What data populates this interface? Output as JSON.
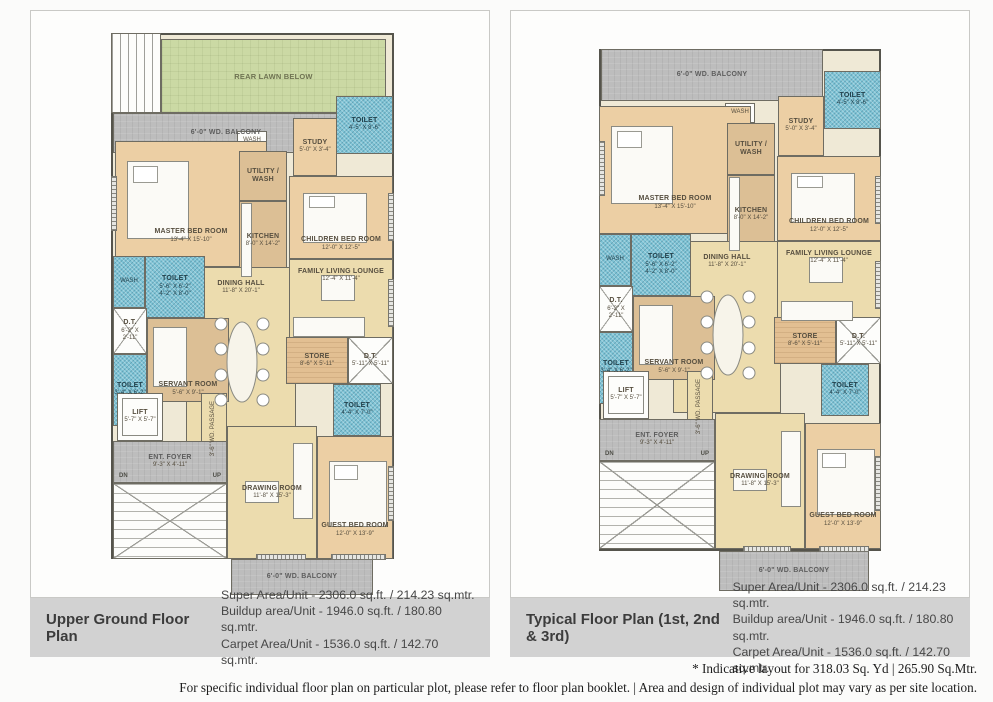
{
  "colors": {
    "toilet_blue": "#7fc4d6",
    "lawn_green": "#cbd9a4",
    "balcony_gray": "#bdbdbd",
    "floor_cream": "#ecdcae",
    "bedroom_tan": "#eccfa4",
    "kitchen_brown": "#dcbf95",
    "caption_band_gray": "#d2d2d2"
  },
  "footer": {
    "line1": "* Indicative layout for 318.03 Sq. Yd | 265.90 Sq.Mtr.",
    "line2": "For specific individual floor plan on particular plot, please refer to floor plan booklet. | Area and design of individual plot may vary as per site location."
  },
  "plans": [
    {
      "title": "Upper Ground Floor Plan",
      "areas": {
        "super": "Super Area/Unit - 2306.0 sq.ft. / 214.23 sq.mtr.",
        "buildup": "Buildup area/Unit - 1946.0 sq.ft. / 180.80 sq.mtr.",
        "carpet": "Carpet Area/Unit - 1536.0 sq.ft. / 142.70 sq.mtr."
      },
      "rooms": {
        "rear_lawn": {
          "label": "REAR LAWN BELOW"
        },
        "top_balcony": {
          "label": "6'-0\" WD. BALCONY"
        },
        "wash_top": {
          "label": "WASH"
        },
        "toilet_top": {
          "label": "TOILET",
          "dims": "4'-5\" X 8'-6\""
        },
        "study": {
          "label": "STUDY",
          "dims": "5'-0\" X 3'-4\""
        },
        "master_bed": {
          "label": "MASTER BED ROOM",
          "dims": "13'-4\" X 15'-10\""
        },
        "utility": {
          "label": "UTILITY / WASH"
        },
        "kitchen": {
          "label": "KITCHEN",
          "dims": "8'-0\" X 14'-2\""
        },
        "children_bed": {
          "label": "CHILDREN BED ROOM",
          "dims": "12'-0\" X 12'-5\""
        },
        "dining": {
          "label": "DINING HALL",
          "dims": "11'-8\" X 20'-1\""
        },
        "family_lounge": {
          "label": "FAMILY LIVING LOUNGE",
          "dims": "12'-4\" X 11'-4\""
        },
        "wash_left": {
          "label": "WASH"
        },
        "toilet_mid": {
          "label": "TOILET",
          "dims": "5'-6\" X 6'-2\"",
          "dims2": "4'-2\" X 8'-0\""
        },
        "dt_left": {
          "label": "D.T.",
          "dims": "6'-2\" X 2'-11\""
        },
        "toilet_lower": {
          "label": "TOILET",
          "dims": "3'-4\" X 6'-2\""
        },
        "servant": {
          "label": "SERVANT ROOM",
          "dims": "5'-6\" X 9'-1\""
        },
        "store": {
          "label": "STORE",
          "dims": "8'-6\" X 5'-11\""
        },
        "dt_right": {
          "label": "D.T.",
          "dims": "5'-11\" X 5'-11\""
        },
        "toilet_right": {
          "label": "TOILET",
          "dims": "4'-4\" X 7'-0\""
        },
        "lift": {
          "label": "LIFT",
          "dims": "5'-7\" X 5'-7\""
        },
        "passage": {
          "label": "3'-6\" WD. PASSAGE"
        },
        "ent_foyer": {
          "label": "ENT. FOYER",
          "dims": "9'-3\" X 4'-11\""
        },
        "dn": {
          "label": "DN"
        },
        "up": {
          "label": "UP"
        },
        "drawing": {
          "label": "DRAWING ROOM",
          "dims": "11'-8\" X 15'-3\""
        },
        "guest_bed": {
          "label": "GUEST BED ROOM",
          "dims": "12'-0\" X 13'-9\""
        },
        "bottom_balcony": {
          "label": "6'-0\" WD. BALCONY"
        }
      }
    },
    {
      "title": "Typical Floor Plan (1st, 2nd & 3rd)",
      "areas": {
        "super": "Super Area/Unit - 2306.0 sq.ft. / 214.23 sq.mtr.",
        "buildup": "Buildup area/Unit - 1946.0 sq.ft. / 180.80 sq.mtr.",
        "carpet": "Carpet Area/Unit - 1536.0 sq.ft. / 142.70 sq.mtr."
      },
      "rooms": {
        "top_balcony": {
          "label": "6'-0\" WD. BALCONY"
        },
        "wash_top": {
          "label": "WASH"
        },
        "toilet_top": {
          "label": "TOILET",
          "dims": "4'-5\" X 8'-6\""
        },
        "study": {
          "label": "STUDY",
          "dims": "5'-0\" X 3'-4\""
        },
        "master_bed": {
          "label": "MASTER BED ROOM",
          "dims": "13'-4\" X 15'-10\""
        },
        "utility": {
          "label": "UTILITY / WASH"
        },
        "kitchen": {
          "label": "KITCHEN",
          "dims": "8'-0\" X 14'-2\""
        },
        "children_bed": {
          "label": "CHILDREN BED ROOM",
          "dims": "12'-0\" X 12'-5\""
        },
        "dining": {
          "label": "DINING HALL",
          "dims": "11'-8\" X 20'-1\""
        },
        "family_lounge": {
          "label": "FAMILY LIVING LOUNGE",
          "dims": "12'-4\" X 11'-4\""
        },
        "wash_left": {
          "label": "WASH"
        },
        "toilet_mid": {
          "label": "TOILET",
          "dims": "5'-6\" X 6'-2\"",
          "dims2": "4'-2\" X 8'-0\""
        },
        "dt_left": {
          "label": "D.T.",
          "dims": "6'-2\" X 2'-11\""
        },
        "toilet_lower": {
          "label": "TOILET",
          "dims": "3'-4\" X 6'-2\""
        },
        "servant": {
          "label": "SERVANT ROOM",
          "dims": "5'-6\" X 9'-1\""
        },
        "store": {
          "label": "STORE",
          "dims": "8'-6\" X 5'-11\""
        },
        "dt_right": {
          "label": "D.T.",
          "dims": "5'-11\" X 5'-11\""
        },
        "toilet_right": {
          "label": "TOILET",
          "dims": "4'-4\" X 7'-0\""
        },
        "lift": {
          "label": "LIFT",
          "dims": "5'-7\" X 5'-7\""
        },
        "passage": {
          "label": "3'-6\" WD. PASSAGE"
        },
        "ent_foyer": {
          "label": "ENT. FOYER",
          "dims": "9'-3\" X 4'-11\""
        },
        "dn": {
          "label": "DN"
        },
        "up": {
          "label": "UP"
        },
        "drawing": {
          "label": "DRAWING ROOM",
          "dims": "11'-8\" X 15'-3\""
        },
        "guest_bed": {
          "label": "GUEST BED ROOM",
          "dims": "12'-0\" X 13'-9\""
        },
        "bottom_balcony": {
          "label": "6'-0\" WD. BALCONY"
        }
      }
    }
  ]
}
